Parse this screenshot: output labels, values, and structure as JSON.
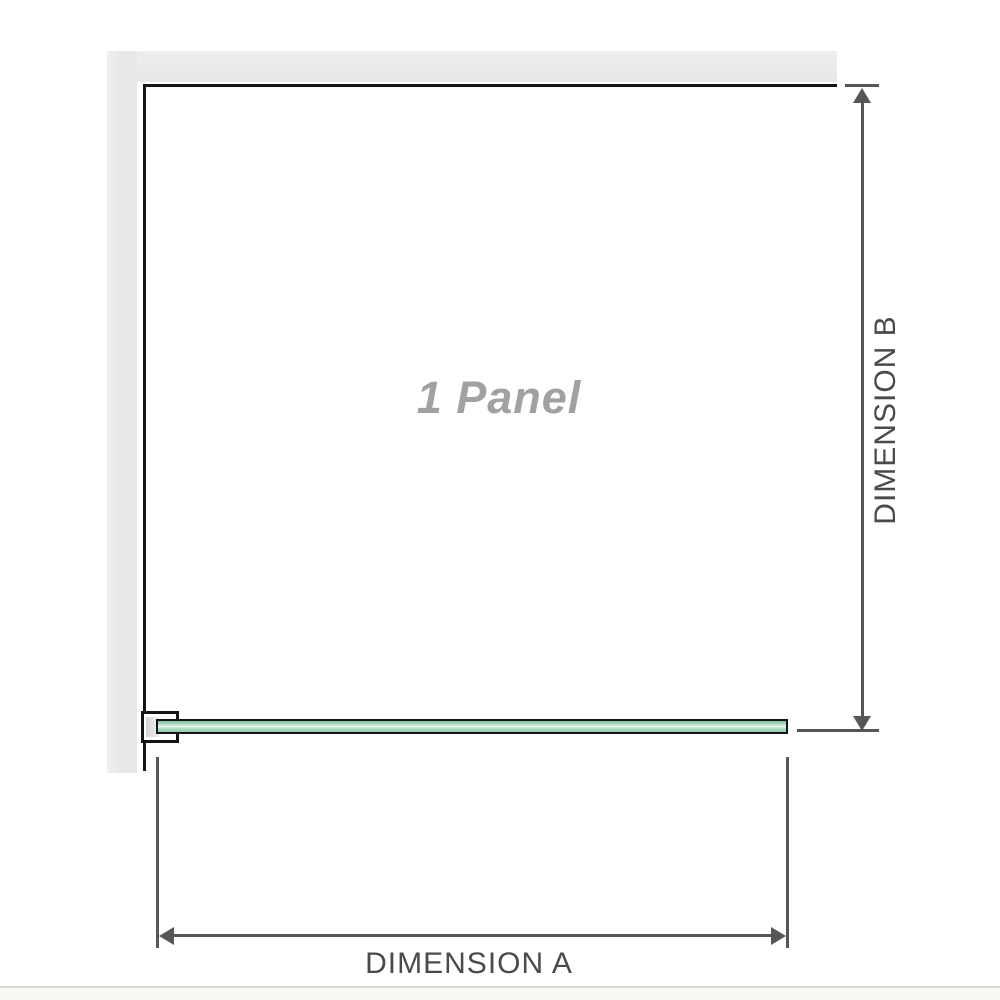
{
  "diagram": {
    "title_label": "1 Panel",
    "dimension_a_label": "DIMENSION A",
    "dimension_b_label": "DIMENSION B",
    "colors": {
      "wall_gray": "#e9e9e9",
      "outline_black": "#161616",
      "dimension_line_gray": "#555658",
      "glass_green": "#9fd4b6",
      "glass_highlight": "#eef8f1",
      "panel_label_gray": "#a1a1a1",
      "dimension_label_gray": "#4a4a4b"
    }
  }
}
